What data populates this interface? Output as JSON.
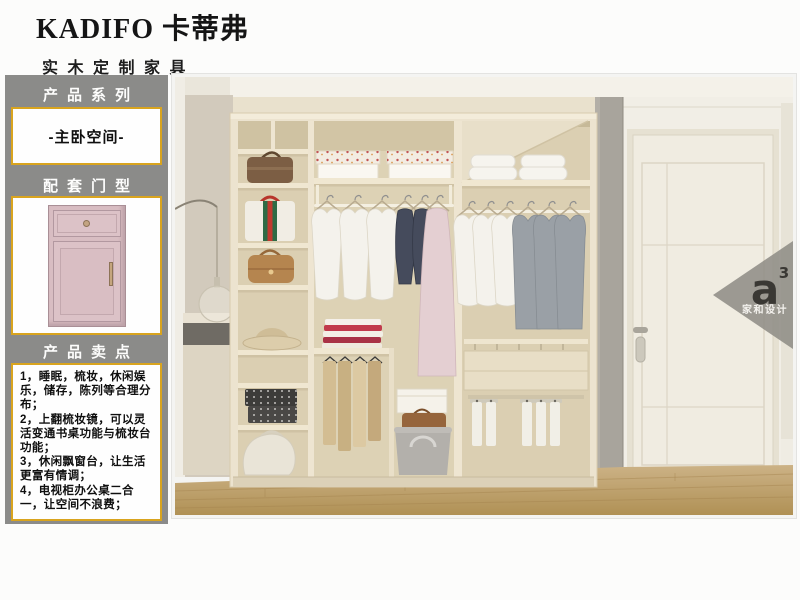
{
  "brand": {
    "name": "KADIFO 卡蒂弗",
    "tagline": "实木定制家具"
  },
  "sidebar": {
    "section_series": {
      "title": "产品系列",
      "value": "-主卧空间-"
    },
    "section_door": {
      "title": "配套门型"
    },
    "section_points": {
      "title": "产品卖点",
      "points": [
        "1，睡眠，梳妆，休闲娱乐，储存，陈列等合理分布；",
        "2，上翻梳妆镜，可以灵活变通书桌功能与梳妆台功能；",
        "3，休闲飘窗台，让生活更富有情调；",
        "4，电视柜办公桌二合一，让空间不浪费；"
      ]
    }
  },
  "photo": {
    "watermark": {
      "logo": "a",
      "logo_sup": "3",
      "caption": "家和设计"
    }
  },
  "colors": {
    "sidebar_bg": "#8b8b89",
    "box_border": "#d9a41e",
    "door_pink": "#d8bdc2",
    "wardrobe_cream": "#ece3cf",
    "floor_wood": "#c0a271"
  }
}
